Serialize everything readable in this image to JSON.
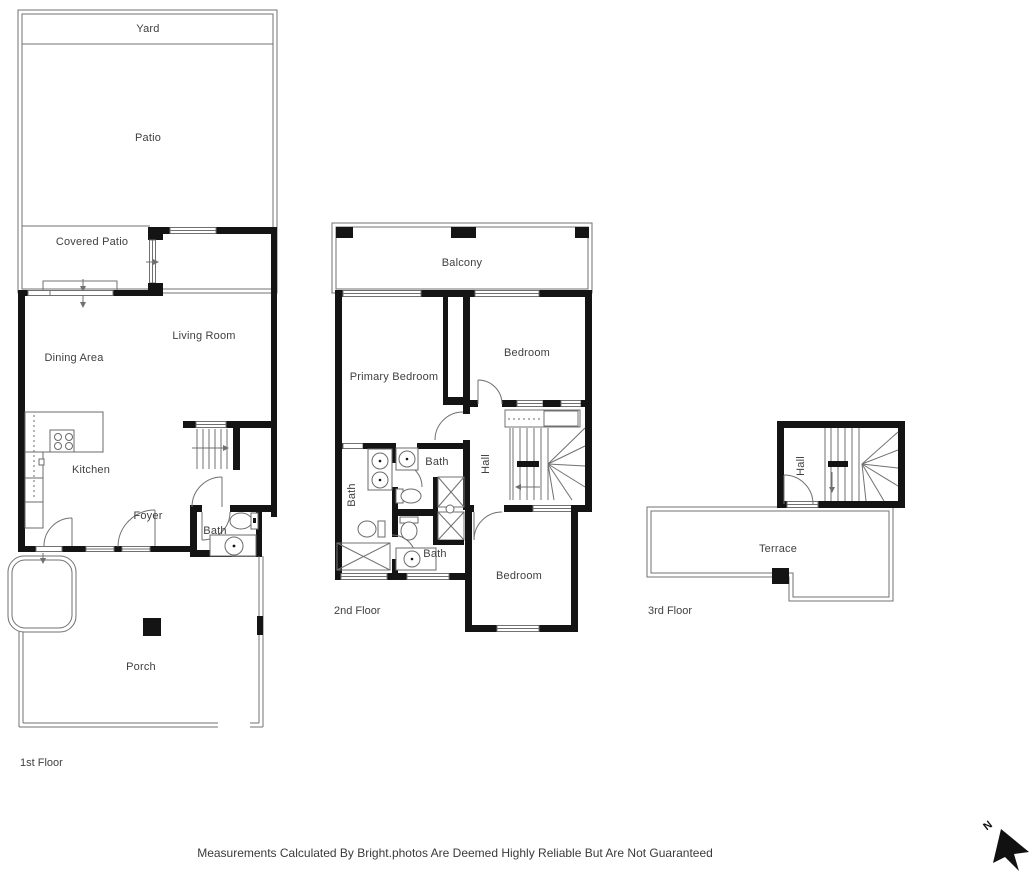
{
  "floors": {
    "first": {
      "label": "1st Floor",
      "rooms": {
        "yard": "Yard",
        "patio": "Patio",
        "covered_patio": "Covered Patio",
        "living_room": "Living Room",
        "dining_area": "Dining Area",
        "kitchen": "Kitchen",
        "foyer": "Foyer",
        "bath": "Bath",
        "porch": "Porch"
      }
    },
    "second": {
      "label": "2nd Floor",
      "rooms": {
        "balcony": "Balcony",
        "primary_bedroom": "Primary Bedroom",
        "bedroom_upper": "Bedroom",
        "bath_left": "Bath",
        "bath_middle": "Bath",
        "hall": "Hall",
        "bath_lower": "Bath",
        "bedroom_lower": "Bedroom"
      }
    },
    "third": {
      "label": "3rd Floor",
      "rooms": {
        "hall": "Hall",
        "terrace": "Terrace"
      }
    }
  },
  "footer": {
    "disclaimer": "Measurements Calculated By Bright.photos Are Deemed Highly Reliable But Are Not Guaranteed"
  },
  "compass": {
    "north_label": "N"
  },
  "colors": {
    "wall": "#141414",
    "thin_line": "#707070",
    "text": "#3f3f3f",
    "background": "#ffffff"
  }
}
